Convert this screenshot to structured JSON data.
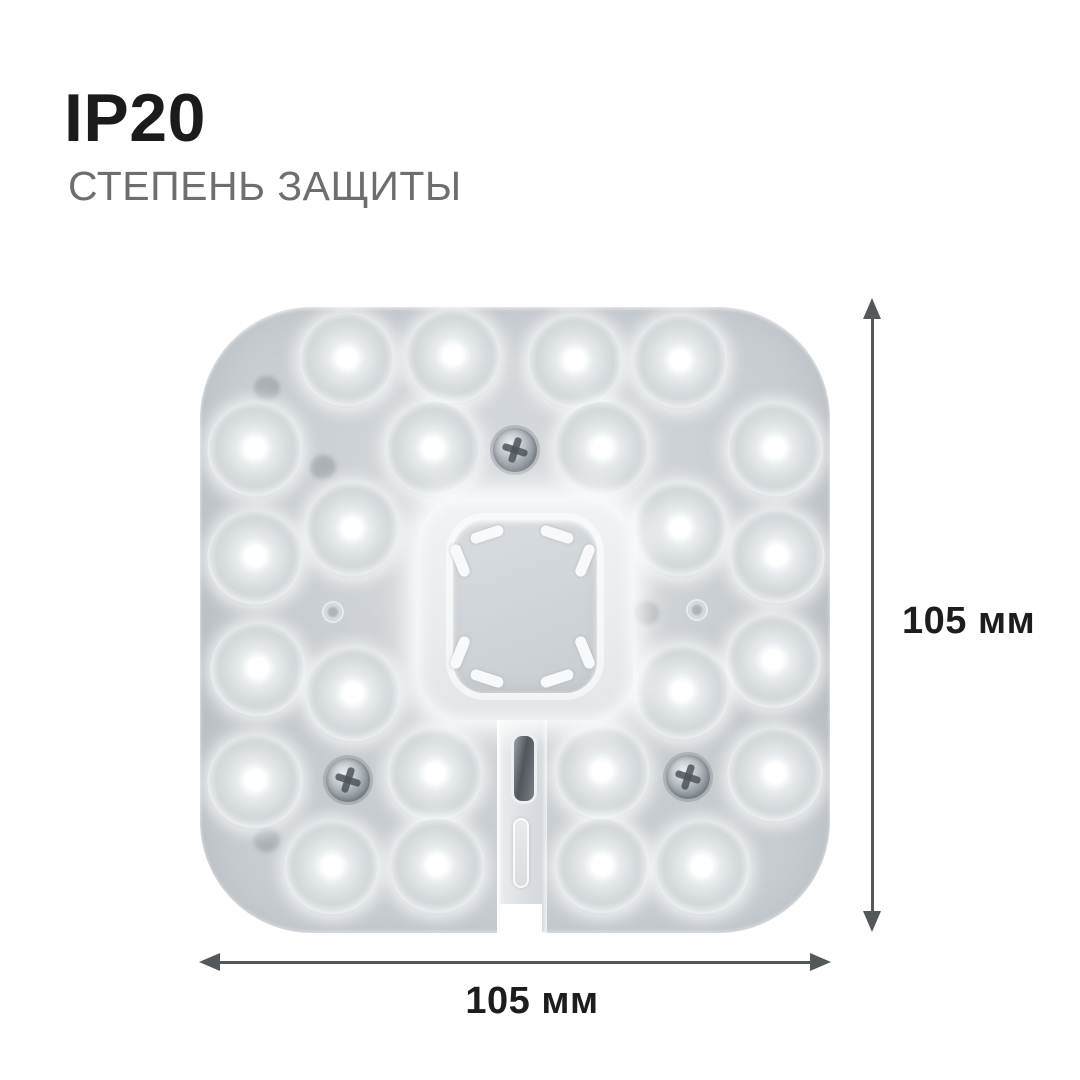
{
  "header": {
    "title": "IP20",
    "subtitle": "СТЕПЕНЬ ЗАЩИТЫ"
  },
  "dimensions": {
    "height_label": "105 мм",
    "width_label": "105 мм"
  },
  "colors": {
    "background": "#ffffff",
    "title_text": "#1b1b1b",
    "subtitle_text": "#6e6e6e",
    "dimension_text": "#1d1d1d",
    "arrow": "#53585b",
    "plate": "#c6cbcf",
    "led_glow": "#ffffff"
  },
  "module_image": {
    "description": "Top view photo of a square LED ceiling-lamp module with rounded corners: 24 LED lenses, central magnet cover with corner slots, three Phillips screws, two pin holes and a connector tab with bottom notch",
    "plate": {
      "x": 200,
      "y": 307,
      "w": 630,
      "h": 626,
      "radius": 112
    },
    "led_diameter": 96,
    "leds": [
      [
        147,
        53
      ],
      [
        253,
        50
      ],
      [
        375,
        55
      ],
      [
        480,
        55
      ],
      [
        55,
        143
      ],
      [
        233,
        143
      ],
      [
        402,
        143
      ],
      [
        575,
        143
      ],
      [
        152,
        223
      ],
      [
        480,
        223
      ],
      [
        55,
        251
      ],
      [
        577,
        250
      ],
      [
        58,
        363
      ],
      [
        573,
        355
      ],
      [
        153,
        388
      ],
      [
        482,
        386
      ],
      [
        55,
        475
      ],
      [
        235,
        468
      ],
      [
        402,
        466
      ],
      [
        575,
        468
      ],
      [
        132,
        561
      ],
      [
        237,
        560
      ],
      [
        402,
        560
      ],
      [
        502,
        561
      ]
    ],
    "screws": [
      [
        315,
        143
      ],
      [
        148,
        473
      ],
      [
        488,
        470
      ]
    ],
    "pin_holes": [
      [
        133,
        305
      ],
      [
        497,
        303
      ]
    ],
    "shadow_spots": [
      [
        67,
        81
      ],
      [
        123,
        160
      ],
      [
        500,
        81
      ],
      [
        553,
        155
      ],
      [
        446,
        306
      ],
      [
        67,
        533
      ],
      [
        500,
        536
      ]
    ],
    "center": {
      "glow": {
        "x": 218,
        "y": 191,
        "w": 215,
        "h": 222
      },
      "cover": {
        "x": 253,
        "y": 213,
        "w": 144,
        "h": 173
      },
      "slot_size": {
        "w": 34,
        "h": 11
      },
      "slots": [
        {
          "x": 287,
          "y": 227,
          "rot": -18
        },
        {
          "x": 357,
          "y": 227,
          "rot": 18
        },
        {
          "x": 260,
          "y": 253,
          "rot": 68
        },
        {
          "x": 385,
          "y": 253,
          "rot": -68
        },
        {
          "x": 260,
          "y": 345,
          "rot": -68
        },
        {
          "x": 385,
          "y": 345,
          "rot": 68
        },
        {
          "x": 287,
          "y": 371,
          "rot": 18
        },
        {
          "x": 357,
          "y": 371,
          "rot": -18
        }
      ]
    },
    "tab": {
      "x": 297,
      "y": 403,
      "w": 50,
      "h": 223,
      "dark_slot": {
        "x": 311,
        "y": 426,
        "w": 20,
        "h": 65
      },
      "light_slot": {
        "x": 313,
        "y": 511,
        "w": 16,
        "h": 70
      },
      "notch": {
        "x": 300,
        "y": 597,
        "w": 42,
        "h": 31
      }
    }
  }
}
